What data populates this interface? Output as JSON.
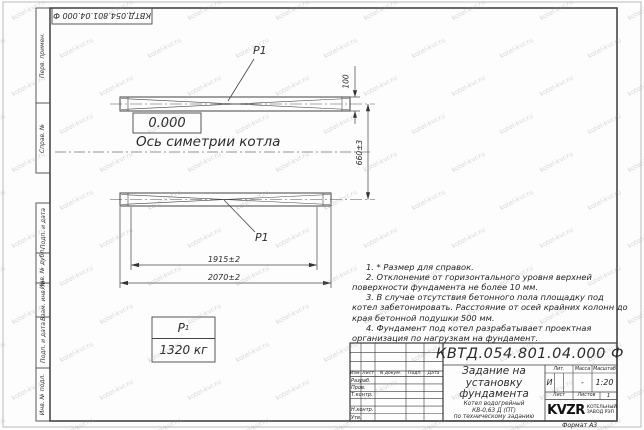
{
  "watermark": {
    "text": "kotel-kvr.ru"
  },
  "top_stamp": {
    "designation": "КВТД.054.801.04.000 Ф"
  },
  "margin_columns": {
    "top": [
      "Перв. примен.",
      "Справ. №"
    ],
    "bottom": [
      "Подп. и дата",
      "Инв. № дубл.",
      "Взам. инв. №",
      "Подп. и дата",
      "Инв. № подл."
    ]
  },
  "drawing": {
    "p1_label": "P1",
    "elevation": "0.000",
    "axis_label": "Ось симетрии котла",
    "dim_thickness": "100",
    "dim_height": "660±3",
    "dim_inner": "1915±2",
    "dim_overall": "2070±2",
    "load_table": {
      "symbol": "Р",
      "symbol_sub": "1",
      "value": "1320 кг"
    }
  },
  "notes": [
    "1. * Размер для справок.",
    "2. Отклонение от горизонтального уровня верхней поверхности фундамента не более 10 мм.",
    "3. В случае отсутствия бетонного пола площадку под котел забетонировать. Расстояние от осей крайних колонн до края бетонной подушки 500 мм.",
    "4. Фундамент под котел разрабатывает проектная организация по нагрузкам на фундамент."
  ],
  "title_block": {
    "designation": "КВТД.054.801.04.000  Ф",
    "title_lines": [
      "Задание на",
      "установку",
      "фундамента"
    ],
    "subtitle_lines": [
      "Котел водогрейный",
      "КВ-0,63 Д (ПТ)",
      "по техническому заданию"
    ],
    "header_cols": [
      "Изм.",
      "Лист",
      "N докум.",
      "Подп.",
      "Дата"
    ],
    "rows": [
      "Разраб.",
      "Пров.",
      "Т.контр.",
      "",
      "Н.контр.",
      "Утв."
    ],
    "lit_label": "Лит.",
    "lit_value": "И",
    "mass_label": "Масса",
    "mass_value": "-",
    "scale_label": "Масштаб",
    "scale_value": "1:20",
    "sheet_label": "Лист",
    "sheets_label": "Листов",
    "sheets_value": "1",
    "logo_text": "KVZR",
    "org_line1": "КОТЕЛЬНЫЙ",
    "org_line2": "ЗАВОД РЭП",
    "format_label": "Формат А3"
  }
}
